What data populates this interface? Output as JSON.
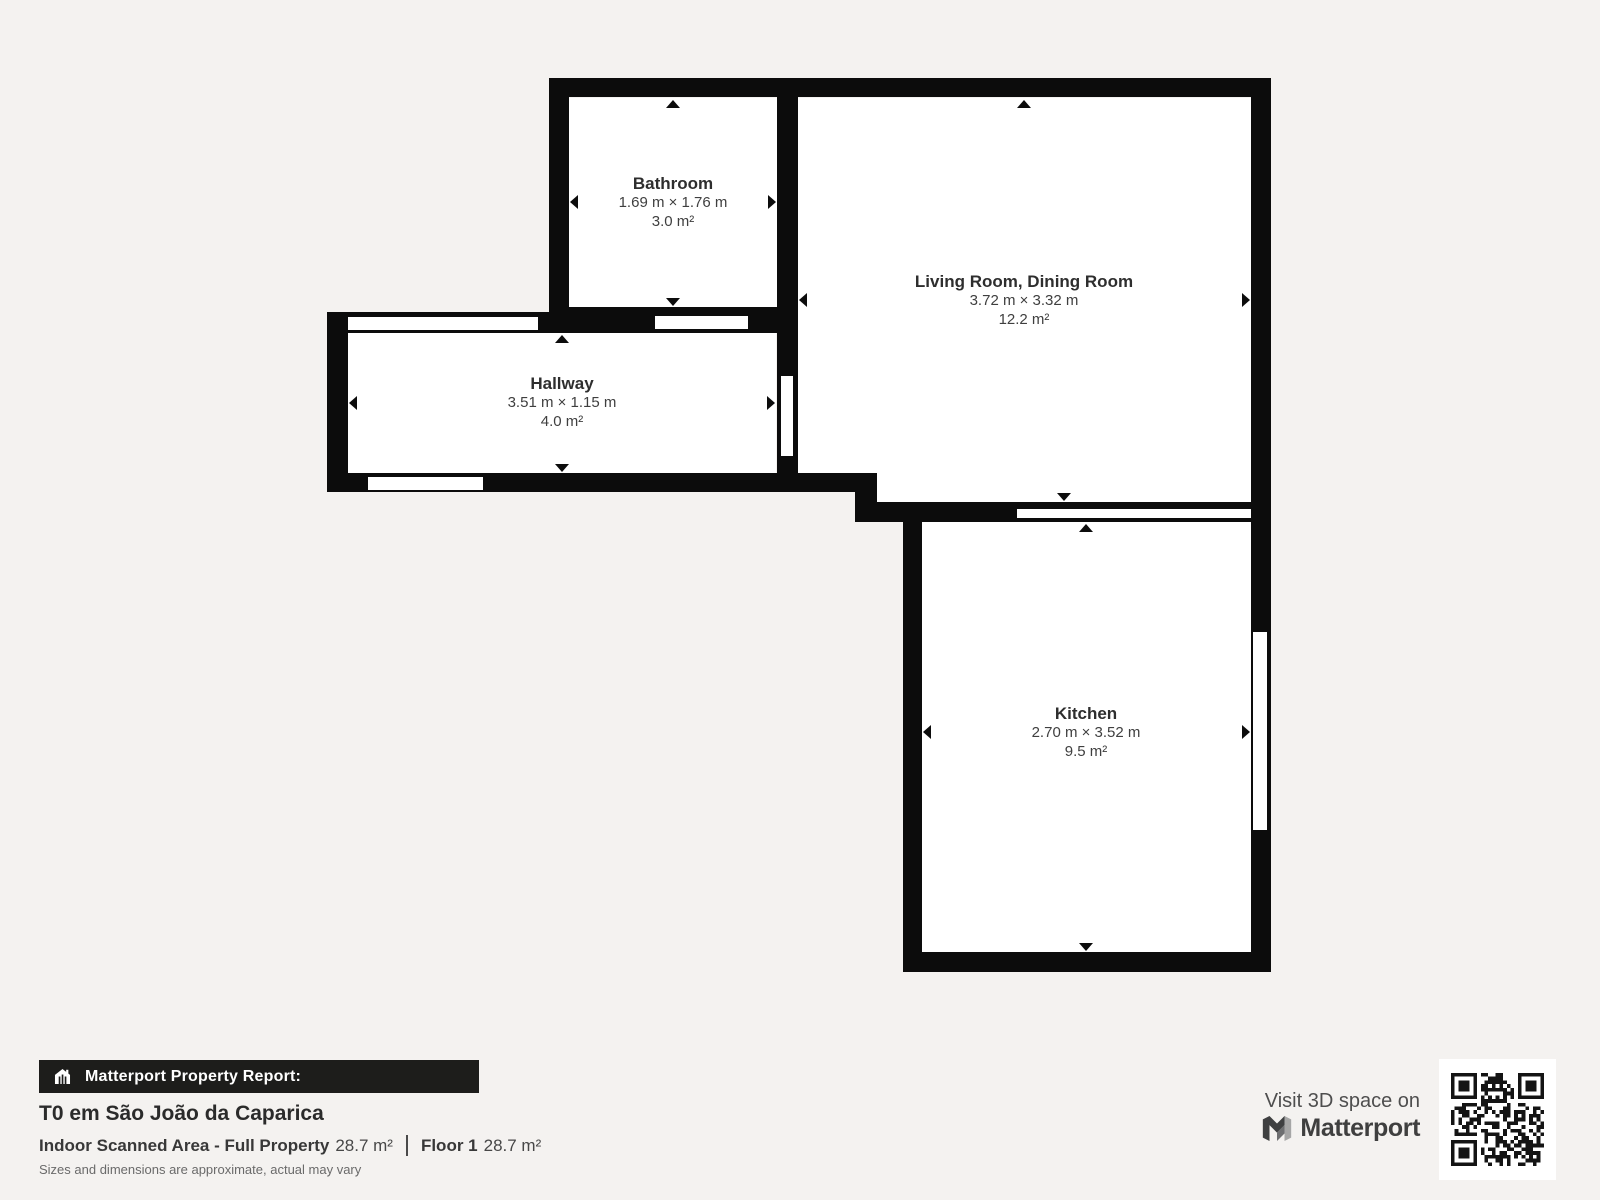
{
  "colors": {
    "bg": "#f4f2f0",
    "wall": "#0c0c0c",
    "room": "#ffffff",
    "bar-bg": "#1d1d1b",
    "bar-ink": "#ffffff",
    "brand-ink": "#3f3f3f"
  },
  "floorplan": {
    "rooms": [
      {
        "id": "bathroom",
        "name": "Bathroom",
        "dimensions": "1.69 m × 1.76 m",
        "area": "3.0 m²"
      },
      {
        "id": "living-dining",
        "name": "Living Room, Dining Room",
        "dimensions": "3.72 m × 3.32 m",
        "area": "12.2 m²"
      },
      {
        "id": "hallway",
        "name": "Hallway",
        "dimensions": "3.51 m × 1.15 m",
        "area": "4.0 m²"
      },
      {
        "id": "kitchen",
        "name": "Kitchen",
        "dimensions": "2.70 m × 3.52 m",
        "area": "9.5 m²"
      }
    ]
  },
  "report": {
    "bar_label": "Matterport Property Report:",
    "title": "T0 em São João da Caparica",
    "indoor_label": "Indoor Scanned Area - Full Property",
    "indoor_value": "28.7 m²",
    "floor_label": "Floor 1",
    "floor_value": "28.7 m²",
    "disclaimer": "Sizes and dimensions are approximate, actual may vary"
  },
  "footer": {
    "visit_text": "Visit 3D space on",
    "brand": "Matterport"
  }
}
